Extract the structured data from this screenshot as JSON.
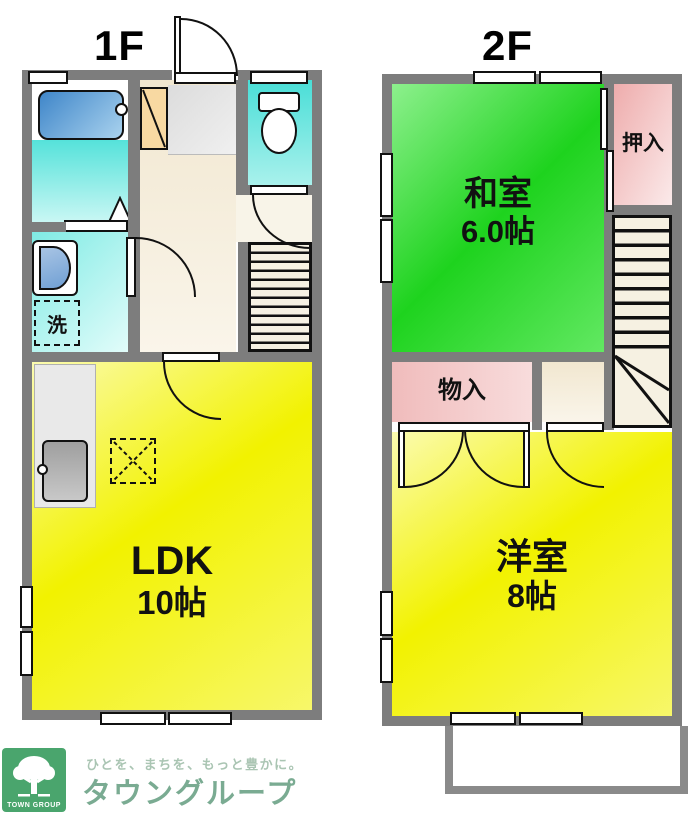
{
  "floors": {
    "f1": {
      "label": "1F",
      "ldk": {
        "name": "LDK",
        "size": "10帖"
      },
      "laundry": "洗"
    },
    "f2": {
      "label": "2F",
      "washitsu": {
        "name": "和室",
        "size": "6.0帖"
      },
      "oshiire": "押入",
      "monoire": "物入",
      "youshitsu": {
        "name": "洋室",
        "size": "8帖"
      }
    }
  },
  "footer": {
    "tagline": "ひとを、まちを、もっと豊かに。",
    "brand": "タウングループ",
    "logo_caption": "TOWN GROUP"
  },
  "colors": {
    "wall": "#7d7d7d",
    "tatami-green": "#1ed31e",
    "room-yellow": "#f2f200",
    "closet-pink": "#efaeae",
    "water-cyan": "#49ded7",
    "tub-blue": "#3f86c9",
    "hall-beige": "#f1e7d0",
    "cabinet-orange": "#f8d9a2",
    "brand-green": "#4aa56d",
    "brand-text": "#7aab92",
    "tagline-text": "#aac5b3"
  }
}
